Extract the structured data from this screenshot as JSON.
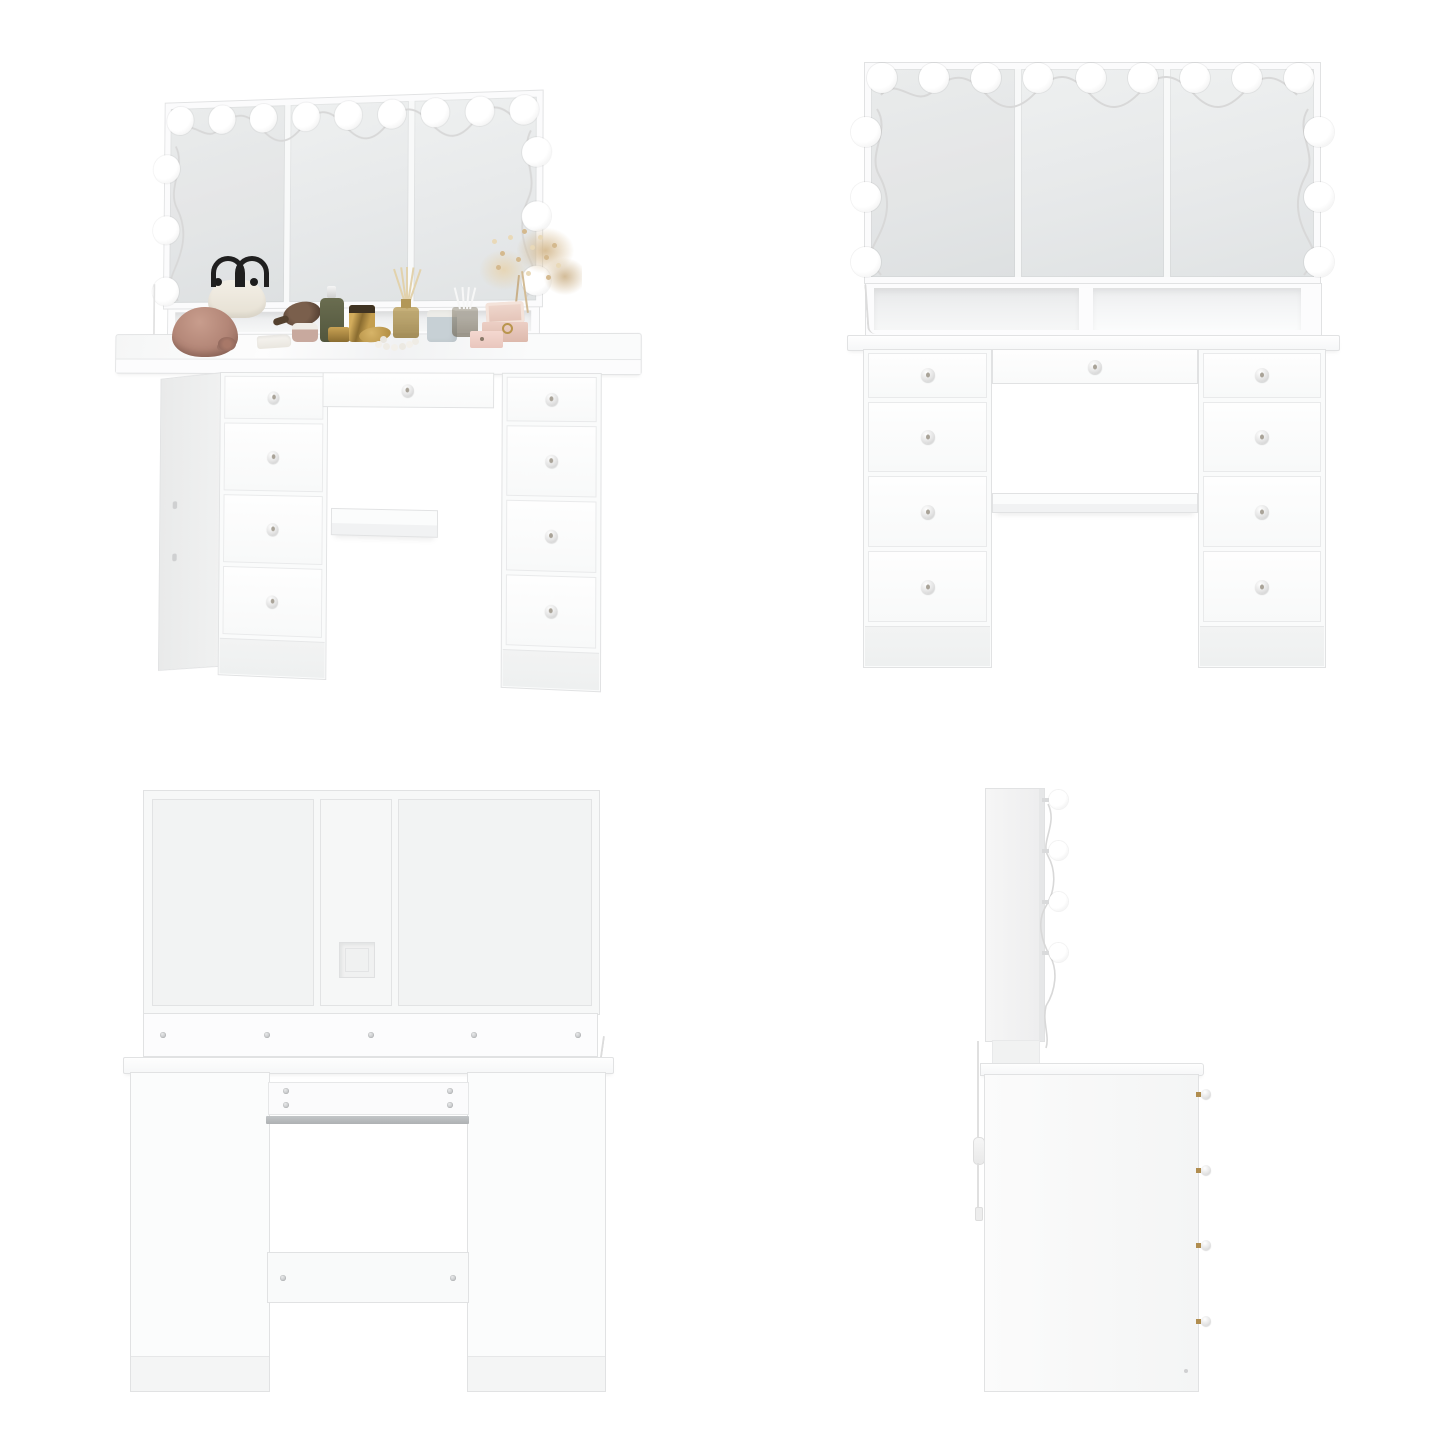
{
  "image": {
    "kind": "furniture-product-photo-grid",
    "background": "#ffffff",
    "subject": "white-vanity-dressing-table-with-hollywood-mirror",
    "view_names": [
      "angled-view",
      "front-view",
      "back-view",
      "side-view"
    ]
  },
  "theme": {
    "colors": {
      "edge": "#e1e2e3",
      "line": "#e6e7e8",
      "interior": "#e7e8e9",
      "mirror_hi": "#eef0f0",
      "mirror_lo": "#e0e3e4",
      "bulb": "#ffffff",
      "bulb_rim": "#e9e9e9",
      "wire": "#d8d8d8",
      "metal": "#c2c4c6",
      "knob_pin": "#a9a398",
      "gold_stem": "#b08d4f",
      "cord": "#e0e0e0",
      "hat": "#b38677",
      "hat_dark": "#8f685c",
      "bag": "#f3efe6",
      "bag_handle": "#1f1f1f",
      "cloth": "#f7f5f1",
      "wood": "#7a5f4c",
      "wood_dark": "#4a382c",
      "powder": "#c8a99e",
      "powder_lid": "#f0ede7",
      "green": "#6a6d50",
      "gold": "#c9a254",
      "gold_dark": "#8a6c30",
      "amber": "#b29757",
      "reed": "#e2d2ac",
      "candle_glass": "#c7d0d5",
      "wax": "#edece8",
      "swab": "#f7f7f7",
      "blush": "#e3c2b6",
      "blush_dark": "#ddb9ac",
      "pink": "#f4d8d0",
      "vase": "#d3b8a6",
      "flower": "#d4b98e",
      "flower_light": "#e9d9b8",
      "pearl": "#f3f0ea"
    }
  },
  "views": {
    "angled": {
      "mirror": {
        "panels": 3,
        "top_bulbs": 9,
        "side_bulbs": 3
      },
      "drawers": {
        "left": 4,
        "right": 4,
        "center": 1
      },
      "open_shelf_compartments": 2,
      "knee_shelf": true,
      "decor": [
        {
          "name": "cloche-hat",
          "color": "#b38677"
        },
        {
          "name": "handbag",
          "color": "#f3efe6"
        },
        {
          "name": "folded-cloth",
          "color": "#f7f5f1"
        },
        {
          "name": "wooden-hand-mirror",
          "color": "#7a5f4c"
        },
        {
          "name": "powder-jar",
          "color": "#c8a99e"
        },
        {
          "name": "dropper-bottle",
          "color": "#6a6d50"
        },
        {
          "name": "gold-jar",
          "color": "#c9a254"
        },
        {
          "name": "gold-perfume-bottle",
          "color": "#c49e4e"
        },
        {
          "name": "gold-compact-with-pearls",
          "color": "#d7b468"
        },
        {
          "name": "reed-diffuser",
          "color": "#b29757"
        },
        {
          "name": "candle",
          "color": "#c7d0d5"
        },
        {
          "name": "cotton-swab-cup",
          "color": "#97907f"
        },
        {
          "name": "jewelry-box",
          "color": "#e3c2b6"
        },
        {
          "name": "pink-box",
          "color": "#f4d8d0"
        },
        {
          "name": "vase-with-dried-flowers",
          "color": "#d4b98e"
        }
      ]
    },
    "front": {
      "mirror": {
        "panels": 3,
        "top_bulbs": 9,
        "side_bulbs": 3
      },
      "drawers": {
        "left": 4,
        "right": 4,
        "center": 1
      },
      "open_shelf_compartments": 2,
      "knee_shelf": true
    },
    "back": {
      "rail_screws": 5,
      "board_screws": 4,
      "crossbar_screws": 2,
      "cable_hole": true
    },
    "side": {
      "bulbs": 4,
      "knobs": 4,
      "power_cord_with_switch": true
    }
  }
}
